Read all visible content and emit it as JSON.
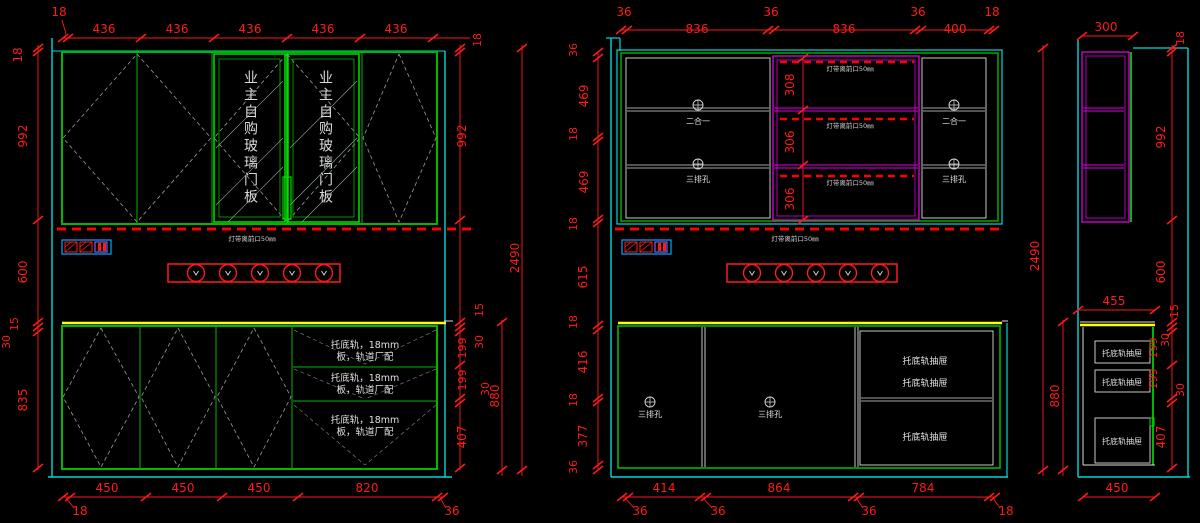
{
  "colors": {
    "background": "#000000",
    "dimension_red": "#FF1A1A",
    "cabinet_green": "#00B800",
    "door_green": "#00E000",
    "wall_cyan": "#00D8D8",
    "section_magenta": "#E000E0",
    "detail_white": "#DCDCDC",
    "countertop_yellow": "#FFFF00",
    "hatch_gray": "#9A9A9A"
  },
  "labels": {
    "glass_door": "业主自购玻璃门板",
    "led": "灯带离前口50㎜",
    "two_in_one": "二合一",
    "three_row_holes": "三排孔",
    "rail_drawer_line1": "托底轨，18mm",
    "rail_drawer_line2": "板，轨道厂配",
    "bottom_rail_drawer": "托底轨抽屉"
  },
  "dims": {
    "left": {
      "top": [
        "18",
        "436",
        "436",
        "436",
        "436",
        "436"
      ],
      "left_chain": [
        "18",
        "992",
        "600",
        "15",
        "30",
        "835"
      ],
      "right_chain": [
        "18",
        "992",
        "15",
        "30",
        "199",
        "199",
        "30",
        "407"
      ],
      "outer": [
        "2490",
        "880"
      ],
      "bottom": [
        "18",
        "450",
        "450",
        "450",
        "820",
        "36"
      ]
    },
    "middle": {
      "top": [
        "36",
        "836",
        "36",
        "836",
        "36",
        "400",
        "18"
      ],
      "left_chain": [
        "36",
        "469",
        "18",
        "469",
        "18",
        "615",
        "18",
        "416",
        "18",
        "377",
        "36"
      ],
      "led_chain": [
        "308",
        "306",
        "306"
      ],
      "bottom": [
        "36",
        "414",
        "36",
        "864",
        "36",
        "784",
        "18"
      ]
    },
    "right": {
      "top": [
        "300"
      ],
      "outer": [
        "2490",
        "880"
      ],
      "right_chain": [
        "18",
        "992",
        "600",
        "15",
        "30",
        "199",
        "199",
        "30",
        "407"
      ],
      "mid_width": [
        "455"
      ],
      "bottom": [
        "450"
      ]
    }
  }
}
